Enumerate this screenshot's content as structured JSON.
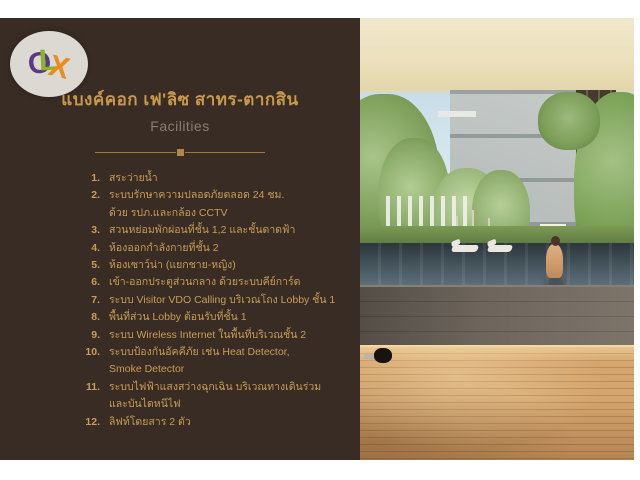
{
  "watermark": {
    "name": "OLX logo",
    "letters": [
      {
        "ch": "O",
        "color": "#5b3a84"
      },
      {
        "ch": "L",
        "color": "#8db327"
      },
      {
        "ch": "X",
        "color": "#ec8a20"
      }
    ],
    "circle_color": "#dcd8d2"
  },
  "header": {
    "title": "แบงค์คอก เฟ'ลิซ สาทร-ตากสิน",
    "subtitle": "Facilities"
  },
  "facilities": {
    "items": [
      {
        "num": "1.",
        "text": "สระว่ายน้ำ"
      },
      {
        "num": "2.",
        "text": "ระบบรักษาความปลอดภัยตลอด 24 ชม.\nด้วย รปภ.และกล้อง CCTV"
      },
      {
        "num": "3.",
        "text": "สวนหย่อมพักผ่อนที่ชั้น 1,2 และชั้นดาดฟ้า"
      },
      {
        "num": "4.",
        "text": "ห้องออกกำลังกายที่ชั้น 2"
      },
      {
        "num": "5.",
        "text": "ห้องเซาว์น่า (แยกชาย-หญิง)"
      },
      {
        "num": "6.",
        "text": "เข้า-ออกประตูส่วนกลาง ด้วยระบบคีย์การ์ด"
      },
      {
        "num": "7.",
        "text": "ระบบ Visitor VDO Calling บริเวณโถง Lobby ชั้น 1"
      },
      {
        "num": "8.",
        "text": "พื้นที่ส่วน Lobby ต้อนรับที่ชั้น 1"
      },
      {
        "num": "9.",
        "text": "ระบบ Wireless Internet ในพื้นที่บริเวณชั้น 2"
      },
      {
        "num": "10.",
        "text": "ระบบป้องกันอัคคีภัย เช่น Heat Detector,\nSmoke Detector"
      },
      {
        "num": "11.",
        "text": "ระบบไฟฟ้าแสงสว่างฉุกเฉิน บริเวณทางเดินร่วม\nและบันไดหนีไฟ"
      },
      {
        "num": "12.",
        "text": "ลิฟท์โดยสาร 2 ตัว"
      }
    ]
  },
  "colors": {
    "panel_brown": "#382c25",
    "title_gold": "#c8994a",
    "list_gold": "#c99e55",
    "subtitle_gray": "#8a7e70",
    "divider_gold": "#9b7a3a",
    "photo_sky_cream": "#ece1bd",
    "photo_pool": "#46555e",
    "photo_wood_deck": "#d4a56e"
  }
}
